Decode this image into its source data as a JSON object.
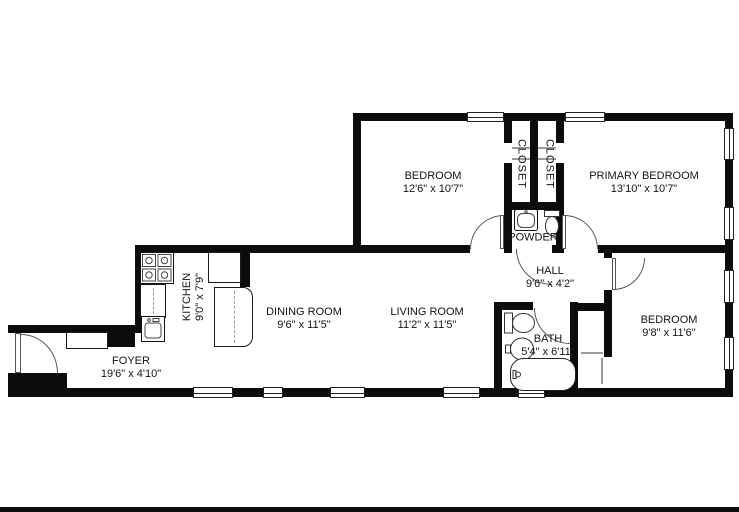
{
  "rooms": {
    "bedroom_top": {
      "name": "BEDROOM",
      "dims": "12'6\" x 10'7\""
    },
    "closet_left": {
      "name": "CLOSET"
    },
    "closet_right": {
      "name": "CLOSET"
    },
    "primary_bedroom": {
      "name": "PRIMARY BEDROOM",
      "dims": "13'10\" x 10'7\""
    },
    "powder": {
      "name": "POWDER"
    },
    "hall": {
      "name": "HALL",
      "dims": "9'6\" x 4'2\""
    },
    "bath": {
      "name": "BATH",
      "dims": "5'4\" x 6'11\""
    },
    "bedroom_right": {
      "name": "BEDROOM",
      "dims": "9'8\" x 11'6\""
    },
    "living_room": {
      "name": "LIVING ROOM",
      "dims": "11'2\" x 11'5\""
    },
    "dining_room": {
      "name": "DINING ROOM",
      "dims": "9'6\" x 11'5\""
    },
    "kitchen": {
      "name": "KITCHEN",
      "dims": "9'0\" x 7'9\""
    },
    "foyer": {
      "name": "FOYER",
      "dims": "19'6\" x 4'10\""
    }
  },
  "colors": {
    "wall": "#0c0c0c",
    "background": "#ffffff",
    "fixture_line": "#333333"
  }
}
